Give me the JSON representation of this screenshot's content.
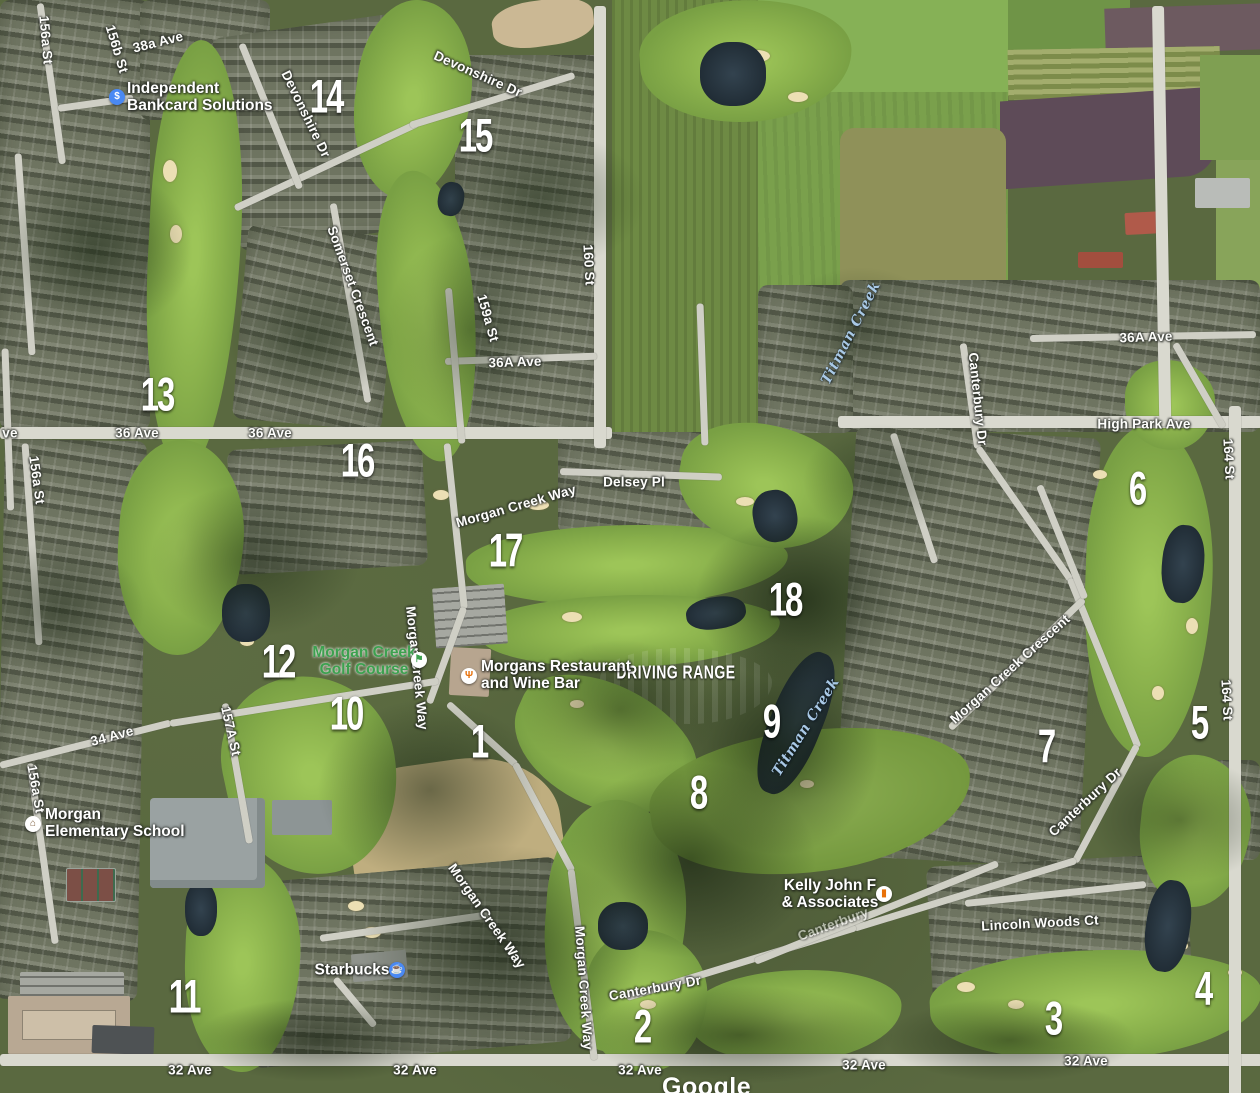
{
  "map": {
    "attribution": "Google",
    "hole_markers": [
      {
        "number": "1",
        "x": 479,
        "y": 741
      },
      {
        "number": "2",
        "x": 642,
        "y": 1026
      },
      {
        "number": "3",
        "x": 1053,
        "y": 1018
      },
      {
        "number": "4",
        "x": 1203,
        "y": 988
      },
      {
        "number": "5",
        "x": 1199,
        "y": 722
      },
      {
        "number": "6",
        "x": 1137,
        "y": 488
      },
      {
        "number": "7",
        "x": 1046,
        "y": 746
      },
      {
        "number": "8",
        "x": 698,
        "y": 792
      },
      {
        "number": "9",
        "x": 771,
        "y": 721
      },
      {
        "number": "10",
        "x": 346,
        "y": 713
      },
      {
        "number": "11",
        "x": 184,
        "y": 996
      },
      {
        "number": "12",
        "x": 278,
        "y": 661
      },
      {
        "number": "13",
        "x": 157,
        "y": 394
      },
      {
        "number": "14",
        "x": 326,
        "y": 96
      },
      {
        "number": "15",
        "x": 475,
        "y": 135
      },
      {
        "number": "16",
        "x": 357,
        "y": 460
      },
      {
        "number": "17",
        "x": 505,
        "y": 550
      },
      {
        "number": "18",
        "x": 785,
        "y": 599
      }
    ],
    "street_labels": [
      {
        "text": "156a St",
        "x": 46,
        "y": 40,
        "rot": 85
      },
      {
        "text": "156b St",
        "x": 117,
        "y": 49,
        "rot": 73
      },
      {
        "text": "38a Ave",
        "x": 158,
        "y": 42,
        "rot": -14
      },
      {
        "text": "Devonshire Dr",
        "x": 306,
        "y": 114,
        "rot": 64
      },
      {
        "text": "Devonshire Dr",
        "x": 478,
        "y": 74,
        "rot": 24
      },
      {
        "text": "Somerset Crescent",
        "x": 353,
        "y": 286,
        "rot": 70
      },
      {
        "text": "159a St",
        "x": 488,
        "y": 318,
        "rot": 74
      },
      {
        "text": "160 St",
        "x": 589,
        "y": 265,
        "rot": 87
      },
      {
        "text": "36A Ave",
        "x": 515,
        "y": 362,
        "rot": -2
      },
      {
        "text": "ve",
        "x": 10,
        "y": 433,
        "rot": 0
      },
      {
        "text": "36 Ave",
        "x": 137,
        "y": 433,
        "rot": 0
      },
      {
        "text": "36 Ave",
        "x": 270,
        "y": 433,
        "rot": 0
      },
      {
        "text": "156a St",
        "x": 37,
        "y": 480,
        "rot": 82
      },
      {
        "text": "36A Ave",
        "x": 1146,
        "y": 337,
        "rot": -2
      },
      {
        "text": "Canterbury Dr",
        "x": 978,
        "y": 399,
        "rot": 84
      },
      {
        "text": "High Park Ave",
        "x": 1144,
        "y": 424,
        "rot": 0
      },
      {
        "text": "164 St",
        "x": 1229,
        "y": 459,
        "rot": 87
      },
      {
        "text": "Morgan Creek Way",
        "x": 516,
        "y": 506,
        "rot": -16
      },
      {
        "text": "Delsey Pl",
        "x": 634,
        "y": 482,
        "rot": 0
      },
      {
        "text": "Morgan Creek Way",
        "x": 417,
        "y": 668,
        "rot": 84
      },
      {
        "text": "Morgan Creek Crescent",
        "x": 1010,
        "y": 669,
        "rot": -42
      },
      {
        "text": "164 St",
        "x": 1227,
        "y": 700,
        "rot": 87
      },
      {
        "text": "34 Ave",
        "x": 112,
        "y": 736,
        "rot": -15
      },
      {
        "text": "157A St",
        "x": 231,
        "y": 731,
        "rot": 77
      },
      {
        "text": "156a St",
        "x": 36,
        "y": 789,
        "rot": 80
      },
      {
        "text": "Canterbury Dr",
        "x": 1085,
        "y": 802,
        "rot": -43
      },
      {
        "text": "Morgan Creek Way",
        "x": 487,
        "y": 916,
        "rot": 55
      },
      {
        "text": "Canterbury",
        "x": 833,
        "y": 924,
        "rot": -20,
        "faded": true
      },
      {
        "text": "Lincoln Woods Ct",
        "x": 1040,
        "y": 923,
        "rot": -3
      },
      {
        "text": "Morgan Creek Way",
        "x": 584,
        "y": 988,
        "rot": 86
      },
      {
        "text": "Canterbury Dr",
        "x": 655,
        "y": 988,
        "rot": -10
      },
      {
        "text": "32 Ave",
        "x": 190,
        "y": 1070,
        "rot": 0
      },
      {
        "text": "32 Ave",
        "x": 415,
        "y": 1070,
        "rot": 0
      },
      {
        "text": "32 Ave",
        "x": 640,
        "y": 1070,
        "rot": 0
      },
      {
        "text": "32 Ave",
        "x": 864,
        "y": 1065,
        "rot": 0
      },
      {
        "text": "32 Ave",
        "x": 1086,
        "y": 1061,
        "rot": 0
      }
    ],
    "water_labels": [
      {
        "text": "Titman Creek",
        "x": 851,
        "y": 333,
        "rot": -63
      },
      {
        "text": "Titman Creek",
        "x": 806,
        "y": 727,
        "rot": -58
      }
    ],
    "area_labels": [
      {
        "text": "DRIVING RANGE",
        "x": 676,
        "y": 673
      }
    ],
    "pois": [
      {
        "id": "independent-bankcard-solutions",
        "lines": [
          "Independent",
          "Bankcard Solutions"
        ],
        "align": "left",
        "x": 127,
        "y": 97,
        "color": "white",
        "icon": {
          "glyph": "$",
          "bg": "#4a89f3",
          "fg": "#ffffff",
          "x": 117,
          "y": 97
        }
      },
      {
        "id": "morgan-creek-golf-course",
        "lines": [
          "Morgan Creek",
          "Golf Course"
        ],
        "align": "center",
        "x": 364,
        "y": 661,
        "color": "green",
        "icon": {
          "glyph": "⚑",
          "bg": "#ffffff",
          "fg": "#3da14f",
          "x": 419,
          "y": 660
        }
      },
      {
        "id": "morgans-restaurant-and-wine-bar",
        "lines": [
          "Morgans Restaurant",
          "and Wine Bar"
        ],
        "align": "left",
        "x": 481,
        "y": 675,
        "color": "white",
        "icon": {
          "glyph": "Ψ",
          "bg": "#ffffff",
          "fg": "#e8710a",
          "x": 469,
          "y": 676
        }
      },
      {
        "id": "starbucks",
        "lines": [
          "Starbucks"
        ],
        "align": "center",
        "x": 352,
        "y": 970,
        "color": "white",
        "icon": {
          "glyph": "☕",
          "bg": "#4a89f3",
          "fg": "#ffffff",
          "x": 397,
          "y": 970
        }
      },
      {
        "id": "kelly-john-f-associates",
        "lines": [
          "Kelly John F",
          "& Associates"
        ],
        "align": "center",
        "x": 830,
        "y": 894,
        "color": "white",
        "icon": {
          "glyph": "▮",
          "bg": "#ffffff",
          "fg": "#e8710a",
          "x": 884,
          "y": 894
        }
      },
      {
        "id": "morgan-elementary-school",
        "lines": [
          "Morgan",
          "Elementary School"
        ],
        "align": "left",
        "x": 45,
        "y": 823,
        "color": "white",
        "icon": {
          "glyph": "⌂",
          "bg": "#ffffff",
          "fg": "#7b5b3a",
          "x": 33,
          "y": 824
        }
      }
    ],
    "colors": {
      "marker_text": "#ffffff",
      "street_text": "#fdfdfb",
      "water_text": "#a9c9e6",
      "golf_label_green": "#3da14f",
      "poi_icon_blue": "#4a89f3",
      "poi_icon_orange": "#e8710a"
    }
  }
}
